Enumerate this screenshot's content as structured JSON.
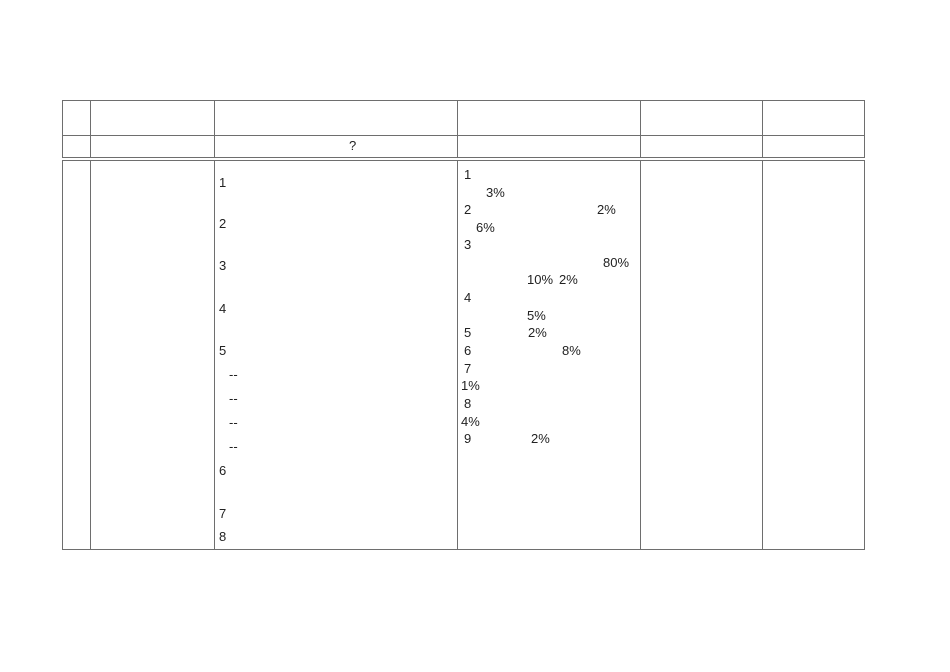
{
  "document": {
    "background_color": "#ffffff",
    "border_color": "#6e6e6e",
    "text_color": "#222222"
  },
  "table": {
    "header_row_cells": [
      "",
      "",
      "",
      "",
      "",
      ""
    ],
    "question_row_cells": [
      "",
      "",
      "",
      "",
      "",
      ""
    ],
    "content_row_cells": [
      "",
      "",
      "",
      "",
      "",
      ""
    ],
    "text_layers": [
      {
        "name": "question-mark-text",
        "items": [
          {
            "text": "?",
            "x": 349,
            "y": 139
          }
        ]
      },
      {
        "name": "procedure-step-text",
        "items": [
          {
            "text": "1",
            "x": 219,
            "y": 176
          },
          {
            "text": "2",
            "x": 219,
            "y": 217
          },
          {
            "text": "3",
            "x": 219,
            "y": 259
          },
          {
            "text": "4",
            "x": 219,
            "y": 302
          },
          {
            "text": "5",
            "x": 219,
            "y": 344
          },
          {
            "text": "--",
            "x": 229,
            "y": 368
          },
          {
            "text": "--",
            "x": 229,
            "y": 392
          },
          {
            "text": "--",
            "x": 229,
            "y": 416
          },
          {
            "text": "--",
            "x": 229,
            "y": 440
          },
          {
            "text": "6",
            "x": 219,
            "y": 464
          },
          {
            "text": "7",
            "x": 219,
            "y": 507
          },
          {
            "text": "8",
            "x": 219,
            "y": 530
          }
        ]
      },
      {
        "name": "content-note-text",
        "items": [
          {
            "text": "1",
            "x": 464,
            "y": 168
          },
          {
            "text": "3%",
            "x": 486,
            "y": 186
          },
          {
            "text": "2",
            "x": 464,
            "y": 203
          },
          {
            "text": "2%",
            "x": 597,
            "y": 203
          },
          {
            "text": "6%",
            "x": 476,
            "y": 221
          },
          {
            "text": "3",
            "x": 464,
            "y": 238
          },
          {
            "text": "80%",
            "x": 603,
            "y": 256
          },
          {
            "text": "10%",
            "x": 527,
            "y": 273
          },
          {
            "text": "2%",
            "x": 559,
            "y": 273
          },
          {
            "text": "4",
            "x": 464,
            "y": 291
          },
          {
            "text": "5%",
            "x": 527,
            "y": 309
          },
          {
            "text": "5",
            "x": 464,
            "y": 326
          },
          {
            "text": "2%",
            "x": 528,
            "y": 326
          },
          {
            "text": "6",
            "x": 464,
            "y": 344
          },
          {
            "text": "8%",
            "x": 562,
            "y": 344
          },
          {
            "text": "7",
            "x": 464,
            "y": 362
          },
          {
            "text": "1%",
            "x": 461,
            "y": 379
          },
          {
            "text": "8",
            "x": 464,
            "y": 397
          },
          {
            "text": "4%",
            "x": 461,
            "y": 415
          },
          {
            "text": "9",
            "x": 464,
            "y": 432
          },
          {
            "text": "2%",
            "x": 531,
            "y": 432
          }
        ]
      }
    ]
  }
}
